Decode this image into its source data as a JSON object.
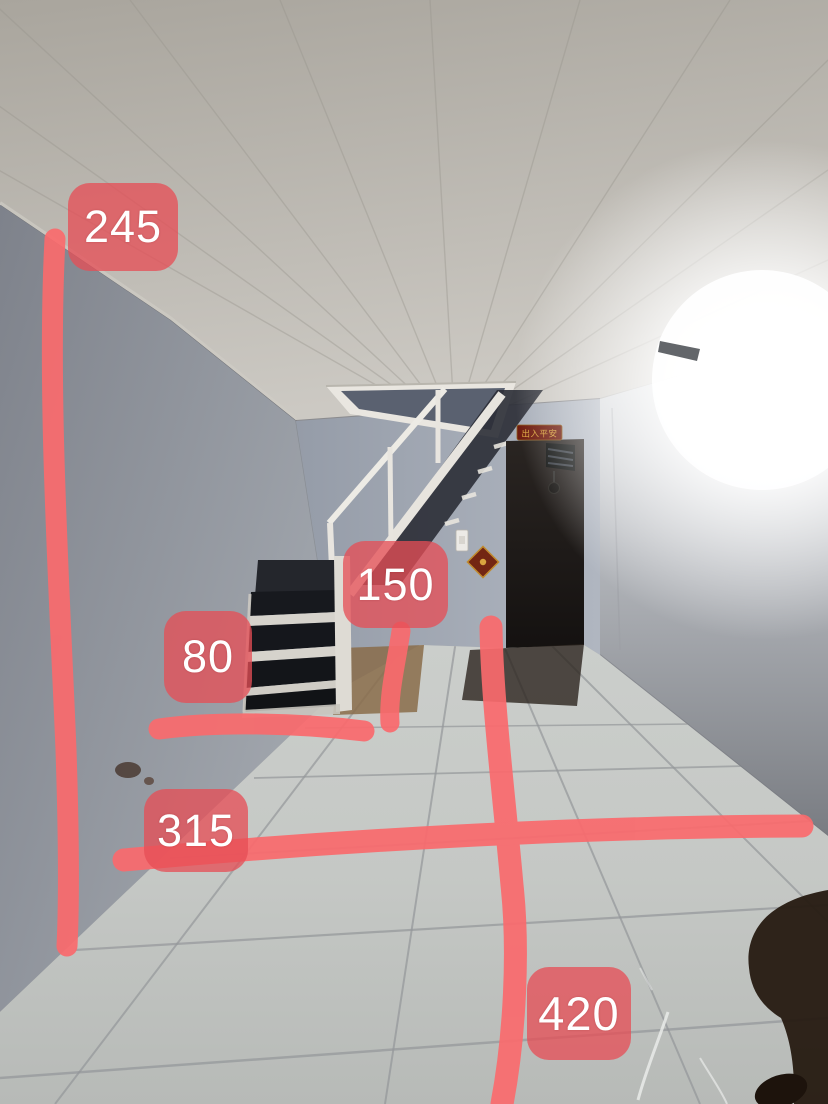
{
  "photo": {
    "description": "Empty narrow room photographed toward a dark doorway: grey-blue walls, plank ceiling with bright fluorescent glare, white steel staircase rising to a ceiling hatch, white tiled floor, hand-drawn red measurement marks",
    "door_sign_text": "出入平安"
  },
  "annotations": {
    "color": "#fa6a6d",
    "label_background": "rgba(230,77,86,0.76)",
    "label_text_color": "#ffffff",
    "labels": [
      {
        "value": "245"
      },
      {
        "value": "150"
      },
      {
        "value": "80"
      },
      {
        "value": "315"
      },
      {
        "value": "420"
      }
    ]
  },
  "scene": {
    "objects": [
      "plank-ceiling",
      "ceiling-hatch",
      "white-steel-staircase",
      "black-stair-treads",
      "left-wall",
      "back-wall",
      "right-wall",
      "dark-doorway",
      "red-door-sign",
      "diamond-talisman",
      "light-switch",
      "tiled-floor",
      "dirt-patch",
      "fluorescent-glare",
      "photographer-shadow"
    ],
    "colors": {
      "ceiling": "#b7b3ab",
      "left_wall": "#8b8f98",
      "back_wall": "#a3aab5",
      "right_wall": "#b4b7bc",
      "floor_tile": "#c6c9c6",
      "grout": "#94979a",
      "stair_tread": "#17191e",
      "stair_frame": "#e6e3dd",
      "doorway": "#1c1815",
      "sign_red": "#6f1c0f",
      "sign_gold": "#dca63e",
      "dirt": "#8a6c4a"
    }
  }
}
